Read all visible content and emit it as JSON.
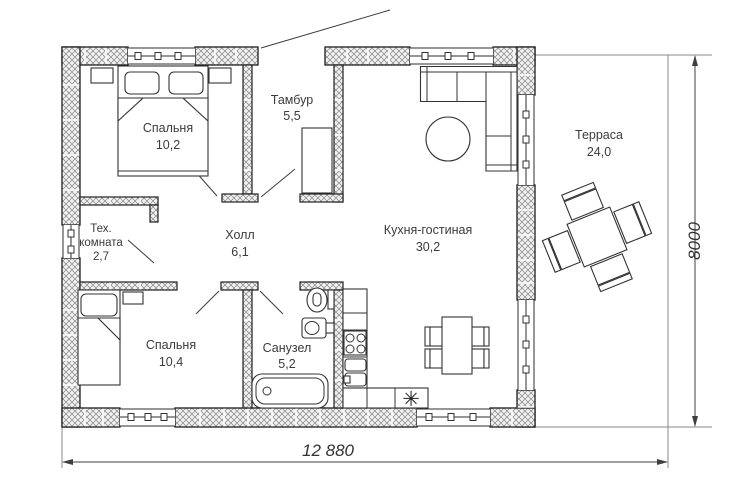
{
  "plan": {
    "rooms": [
      {
        "id": "bedroom1",
        "name": "Спальня",
        "area": "10,2"
      },
      {
        "id": "tambur",
        "name": "Тамбур",
        "area": "5,5"
      },
      {
        "id": "tech",
        "name_line1": "Тех.",
        "name_line2": "комната",
        "area": "2,7"
      },
      {
        "id": "hall",
        "name": "Холл",
        "area": "6,1"
      },
      {
        "id": "kitchen_living",
        "name": "Кухня-гостиная",
        "area": "30,2"
      },
      {
        "id": "bedroom2",
        "name": "Спальня",
        "area": "10,4"
      },
      {
        "id": "sanuzel",
        "name": "Санузел",
        "area": "5,2"
      },
      {
        "id": "terrace",
        "name": "Терраса",
        "area": "24,0"
      }
    ],
    "dimensions": {
      "width_label": "12 880",
      "height_label": "8000"
    },
    "icons": {
      "fridge_star": "✳"
    },
    "colors": {
      "wall_hatch": "#858585",
      "outline": "#1e1e1e",
      "dim_line": "#3f3f3f"
    }
  }
}
